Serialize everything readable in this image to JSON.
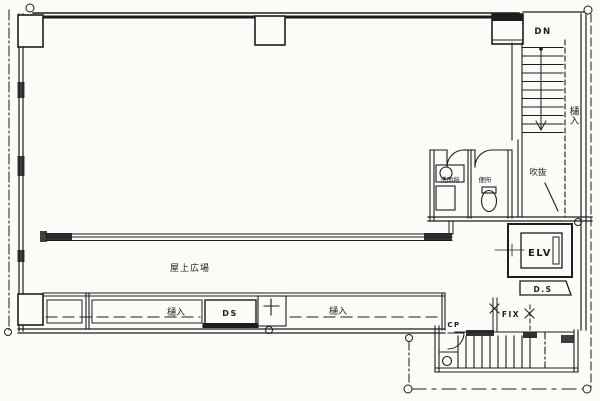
{
  "drawing": {
    "title": "building-floor-plan",
    "colors": {
      "paper": "#fbfbf8",
      "ink": "#1d1d1d"
    },
    "labels": {
      "down": "DN",
      "gutter_vertical": "樋入",
      "void": "吹抜",
      "washroom": "洗面所",
      "toilet": "便所",
      "elevator": "ELV",
      "duct_shaft_right": "D.S",
      "fix_window": "FIX",
      "cp_door": "CP",
      "main_area": "屋上広場",
      "gutter_left": "樋入",
      "duct_shaft_bottom": "DS",
      "gutter_middle": "樋入"
    }
  }
}
